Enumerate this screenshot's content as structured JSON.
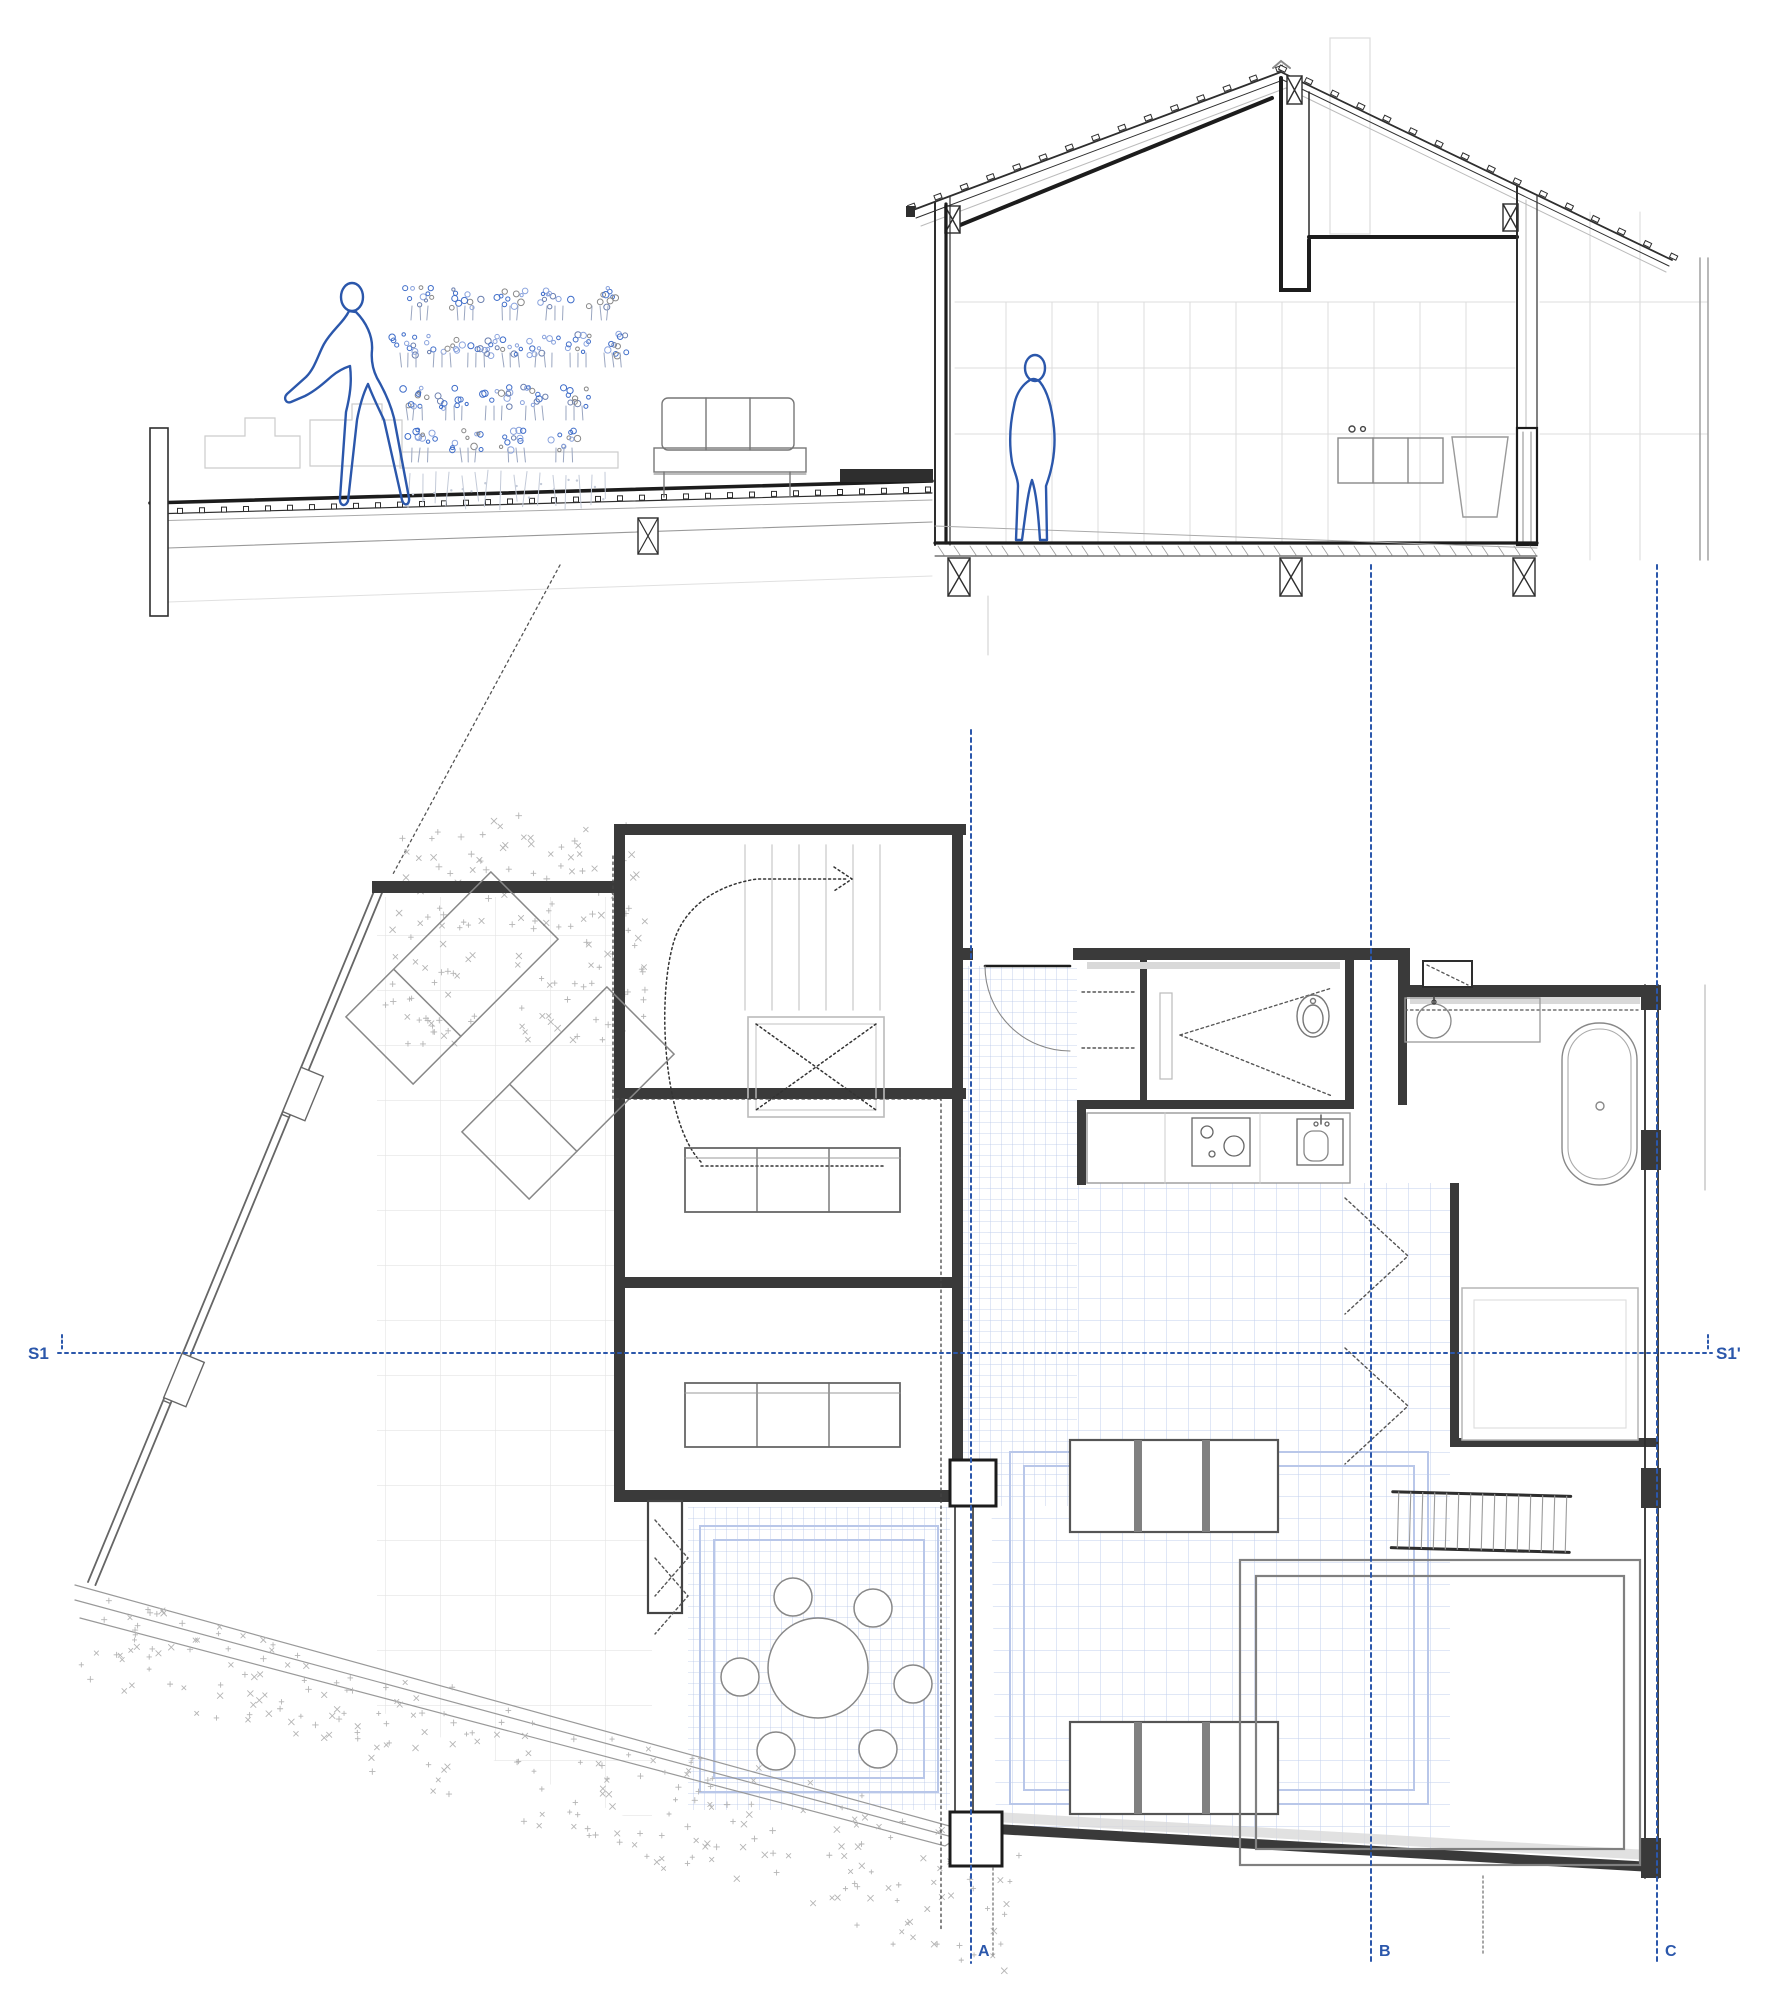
{
  "colors": {
    "ink": "#2e2e2e",
    "ink_mid": "#6e6e6e",
    "ink_light": "#9b9b9b",
    "ink_faint": "#cfcfcf",
    "ink_xfaint": "#e2e2e2",
    "paper": "#ffffff",
    "blue_line": "#2b57ab",
    "tile_blue": "#b7c6e8",
    "tile_blue_light": "#d9e1f3",
    "terrace_grid": "#e4e4e4",
    "veg_blue": "#3f6dc9",
    "veg_blue_light": "#8aa3dd",
    "veg_stem_gray": "#9aa6c0",
    "root_gray": "#c3cad8",
    "scatter_gray": "#b5b5b5",
    "wall_fill": "#3a3a3a",
    "hatch_gray": "#d9d9d9"
  },
  "plan": {
    "section_line": {
      "label_left": "S1",
      "label_right": "S1'",
      "y": 1353,
      "x_start": 58,
      "x_end": 1712
    },
    "grid_lines": [
      {
        "label": "A",
        "x": 971,
        "y_start": 730,
        "y_end": 1963
      },
      {
        "label": "B",
        "x": 1371,
        "y_start": 565,
        "y_end": 1963
      },
      {
        "label": "C",
        "x": 1657,
        "y_start": 565,
        "y_end": 1963
      }
    ],
    "rooms": [
      "terrace",
      "stair-hall",
      "bedroom",
      "entry",
      "pantry",
      "bathroom",
      "kitchen",
      "dining-patio",
      "living-room"
    ]
  },
  "section": {
    "figures": [
      "leaning-person",
      "standing-person"
    ],
    "objects": [
      "green-wall-planting",
      "outdoor-sofa",
      "kitchen-counter",
      "washbasin-vessel",
      "roof-tiles",
      "deck-fasteners"
    ]
  }
}
